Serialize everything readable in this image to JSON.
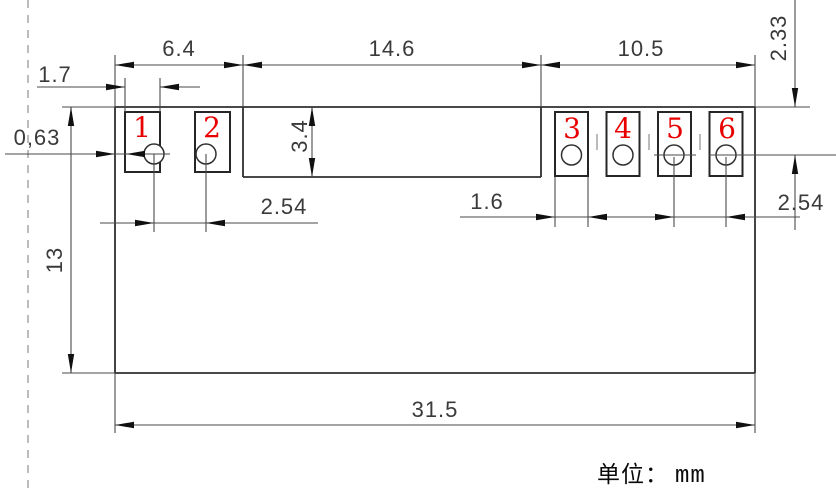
{
  "drawing": {
    "title_note": {
      "unit_label": "单位：",
      "unit_value": "mm"
    },
    "pins": [
      "1",
      "2",
      "3",
      "4",
      "5",
      "6"
    ],
    "dimensions": {
      "left_pads_span": "6.4",
      "center_span": "14.6",
      "right_pads_span": "10.5",
      "pad1_width": "1.7",
      "left_edge_to_pad": "0,63",
      "notch_depth": "3.4",
      "top_to_hole_center": "2.33",
      "left_hole_pitch": "2.54",
      "right_pad_width": "1.6",
      "right_hole_pitch": "2.54",
      "body_height": "13",
      "body_width": "31.5"
    },
    "colors": {
      "pin_number": "#e80000",
      "line": "#2f2f2f",
      "dim_line": "#4a4a4a",
      "dashed_guide": "#ababab"
    }
  }
}
